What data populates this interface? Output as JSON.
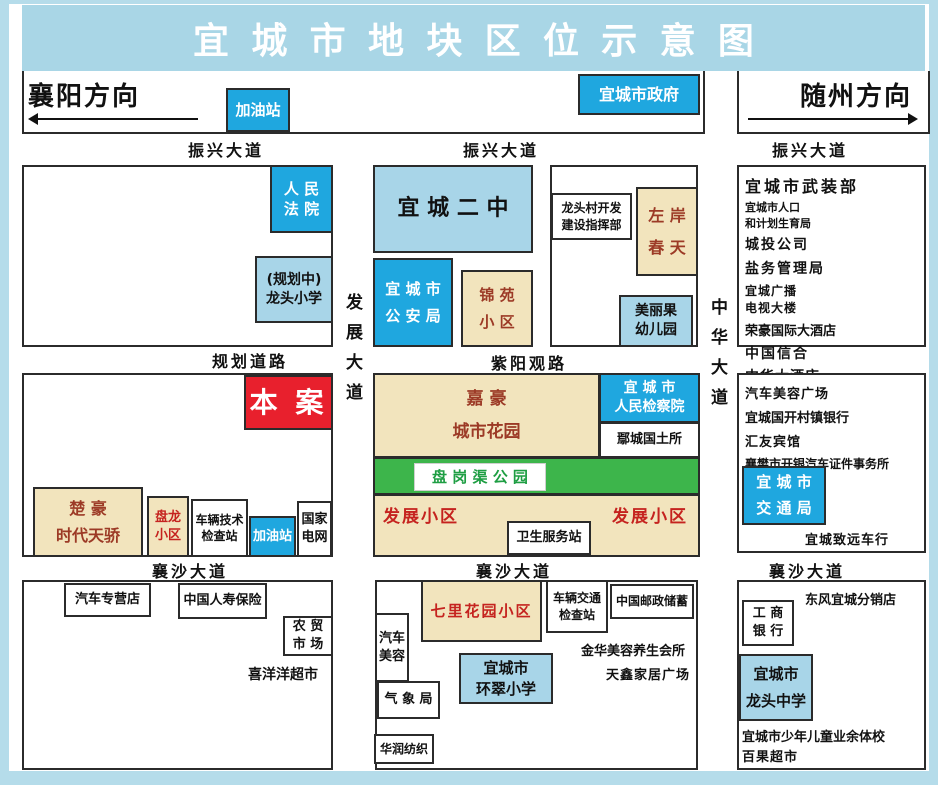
{
  "title": "宜城市地块区位示意图",
  "directions": {
    "west": "襄阳方向",
    "east": "随州方向"
  },
  "roads": {
    "zhenxing_left": "振兴大道",
    "zhenxing_mid": "振兴大道",
    "zhenxing_right": "振兴大道",
    "guihua": "规划道路",
    "ziyang": "紫阳观路",
    "xiangsha_left": "襄沙大道",
    "xiangsha_mid": "襄沙大道",
    "xiangsha_right": "襄沙大道",
    "fazhan_vertical": "发展大道",
    "zhonghua_vertical": "中华大道"
  },
  "top": {
    "gas_station": "加油站",
    "city_government": "宜城市政府"
  },
  "northwest_block": {
    "court": "人 民\n法 院",
    "planned_school": "(规划中)\n龙头小学"
  },
  "north_block": {
    "no2_school": "宜 城 二 中",
    "police": "宜 城 市\n公 安 局",
    "jinyuan_estate": "锦 苑\n小 区",
    "longtou_hq": "龙头村开发\n建设指挥部",
    "zuoan_spring": "左 岸\n春 天",
    "kindergarten": "美丽果\n幼儿园"
  },
  "northeast_list": [
    "宜城市武装部",
    "宜城市人口",
    "和计划生育局",
    "城投公司",
    "盐务管理局",
    "宜城广播",
    "电视大楼",
    "荣豪国际大酒店",
    "中国信合",
    "中华大酒店"
  ],
  "site": {
    "label": "本 案"
  },
  "west_block": {
    "chuhao": "楚 豪\n时代天骄",
    "panlong": "盘龙\n小区",
    "vehicle_tech": "车辆技术\n检查站",
    "gas_station": "加油站",
    "state_grid": "国家\n电网"
  },
  "center_block": {
    "jiahao_garden": "嘉 豪\n城市花园",
    "procuratorate": "宜 城 市\n人民检察院",
    "land_office": "鄢城国土所",
    "park": "盘 岗 渠 公 园",
    "fazhan_left": "发展小区",
    "fazhan_right": "发展小区",
    "health_station": "卫生服务站"
  },
  "east_block": {
    "list": [
      "汽车美容广场",
      "宜城国开村镇银行",
      "汇友宾馆",
      "襄樊市开银汽车证件事务所"
    ],
    "transport_bureau": "宜 城 市\n交 通 局",
    "zhiyuan_autos": "宜城致远车行"
  },
  "southwest_block": {
    "auto_store": "汽车专营店",
    "life_insurance": "中国人寿保险",
    "farmers_market": "农 贸\n市 场",
    "xiyangyang_market": "喜洋洋超市"
  },
  "south_block": {
    "qili_garden": "七里花园小区",
    "auto_beauty": "汽车\n美容",
    "meteorology": "气 象 局",
    "huarun_textile": "华润纺织",
    "huancui_school": "宜城市\n环翠小学",
    "traffic_check": "车辆交通\n检查站",
    "china_post": "中国邮政储蓄",
    "jinhua_spa": "金华美容养生会所",
    "tianxin_plaza": "天鑫家居广场"
  },
  "southeast_block": {
    "dongfeng_store": "东风宜城分销店",
    "icbc": "工 商\n银 行",
    "longtou_middle_school": "宜城市\n龙头中学",
    "youth_sports_school": "宜城市少年儿童业余体校",
    "baiguo_market": "百果超市"
  },
  "colors": {
    "banner": "#a9d6e6",
    "light_blue": "#a8d5e8",
    "blue": "#1fa7df",
    "tan": "#f2e4bd",
    "red": "#e8202d",
    "green": "#3db54b",
    "maroon_text": "#9c3a26",
    "red_text": "#c5231f",
    "green_text": "#1e9e43"
  }
}
